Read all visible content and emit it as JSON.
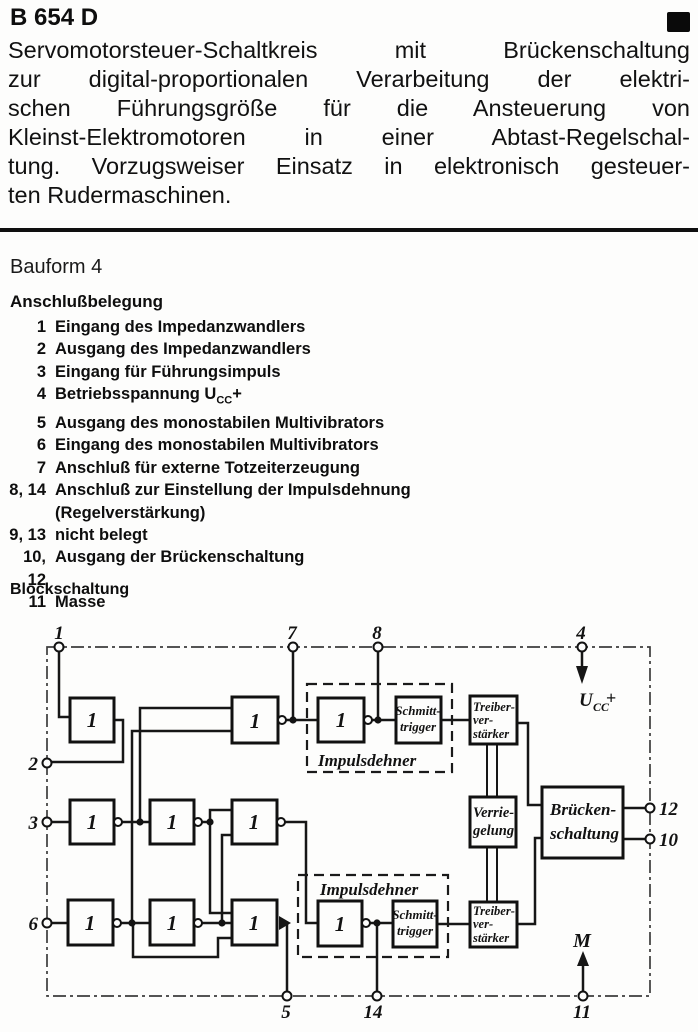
{
  "header": {
    "title": "B 654 D"
  },
  "intro": {
    "lines": [
      "Servomotorsteuer-Schaltkreis mit Brückenschaltung",
      "zur digital-proportionalen Verarbeitung der elektri-",
      "schen Führungsgröße für die Ansteuerung von",
      "Kleinst-Elektromotoren in einer Abtast-Regelschal-",
      "tung. Vorzugsweiser Einsatz in elektronisch gesteuer-",
      "ten Rudermaschinen."
    ]
  },
  "bauform": "Bauform 4",
  "pinout": {
    "heading": "Anschlußbelegung",
    "rows": [
      {
        "num": "1",
        "text": "Eingang des Impedanzwandlers"
      },
      {
        "num": "2",
        "text": "Ausgang des Impedanzwandlers"
      },
      {
        "num": "3",
        "text": "Eingang für Führungsimpuls"
      },
      {
        "num": "4",
        "text": "Betriebsspannung U",
        "sub": "CC",
        "suffix": "+"
      },
      {
        "num": "5",
        "text": "Ausgang des monostabilen Multivibrators"
      },
      {
        "num": "6",
        "text": "Eingang des monostabilen Multivibrators"
      },
      {
        "num": "7",
        "text": "Anschluß für externe Totzeiterzeugung"
      },
      {
        "num": "8, 14",
        "text": "Anschluß zur Einstellung der Impulsdehnung",
        "text2": "(Regelverstärkung)"
      },
      {
        "num": "9, 13",
        "text": "nicht belegt"
      },
      {
        "num": "10, 12",
        "text": "Ausgang der Brückenschaltung"
      },
      {
        "num": "11",
        "text": "Masse"
      }
    ]
  },
  "diagram": {
    "heading": "Blockschaltung",
    "gate_label": "1",
    "labels": {
      "impulsdehner": "Impulsdehner",
      "schmitt_l1": "Schmitt-",
      "schmitt_l2": "trigger",
      "treiber_l1": "Treiber-",
      "treiber_l2": "ver-",
      "treiber_l3": "stärker",
      "verriegelung_l1": "Verrie-",
      "verriegelung_l2": "gelung",
      "bruecken_l1": "Brücken-",
      "bruecken_l2": "schaltung",
      "ucc_main": "U",
      "ucc_sub": "CC",
      "ucc_plus": "+",
      "motor": "M"
    },
    "pins": {
      "p1": "1",
      "p2": "2",
      "p3": "3",
      "p4": "4",
      "p5": "5",
      "p6": "6",
      "p7": "7",
      "p8": "8",
      "p10": "10",
      "p11": "11",
      "p12": "12",
      "p14": "14"
    },
    "colors": {
      "ink": "#131313",
      "border": "#3c3c3c"
    }
  }
}
